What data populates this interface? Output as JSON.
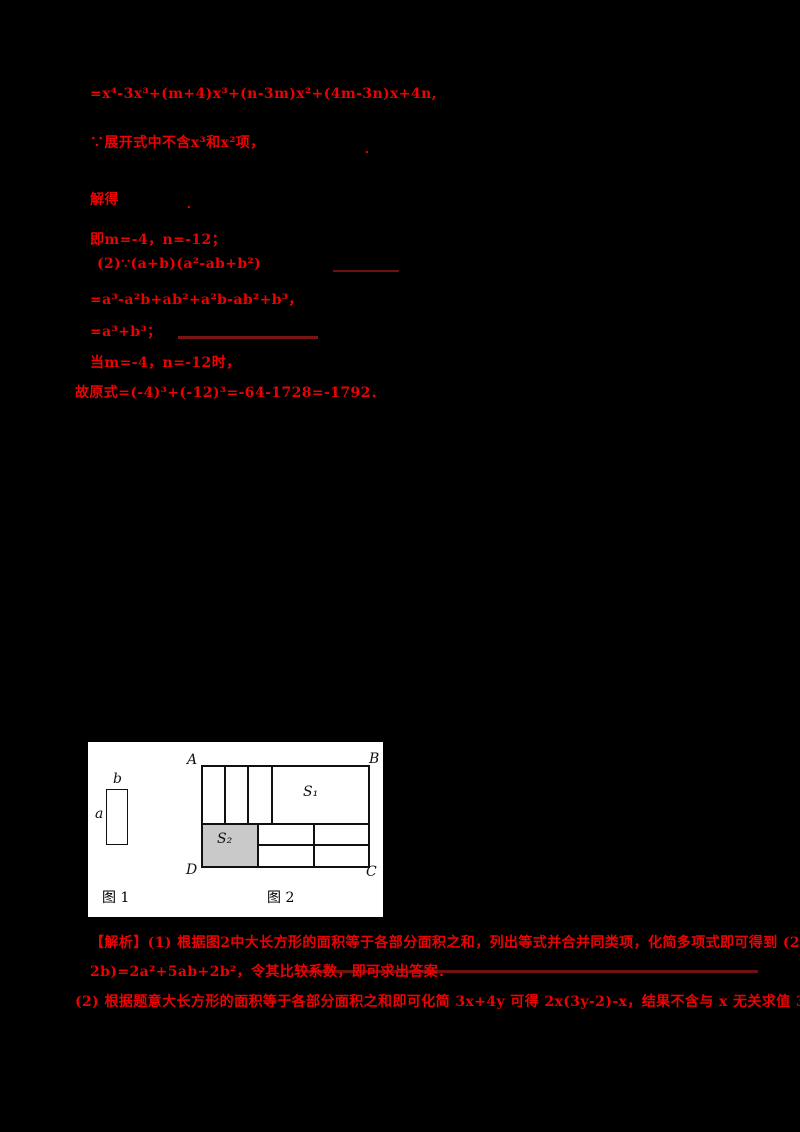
{
  "colors": {
    "background": "#000000",
    "accent_red": "#ec0202",
    "streak_red": "#6e1111",
    "figure_background": "#ffffff",
    "s2_fill": "#c9c9c9"
  },
  "solution": {
    "line1": "=x⁴-3x³+(m+4)x³+(n-3m)x²+(4m-3n)x+4n,",
    "line2": "∵展开式中不含x³和x²项，",
    "line2_period": "．",
    "line3": "解得",
    "line3_period": "．",
    "line4": "即m=-4，n=-12；",
    "line5": "(2)∵(a+b)(a²-ab+b²)",
    "line6": "=a³-a²b+ab²+a²b-ab²+b³，",
    "line7": "=a³+b³；",
    "line8": "当m=-4，n=-12时，",
    "line9": "故原式=(-4)³+(-12)³=-64-1728=-1792．"
  },
  "figure": {
    "fig1": {
      "label_a": "a",
      "label_b": "b",
      "caption": "图 1"
    },
    "fig2": {
      "corner_a": "A",
      "corner_b": "B",
      "corner_c": "C",
      "corner_d": "D",
      "region_s1": "S₁",
      "region_s2": "S₂",
      "caption": "图 2"
    }
  },
  "analysis": {
    "line1": "【解析】(1) 根据图2中大长方形的面积等于各部分面积之和，列出等式并合并同类项，化简多项式即可得到 (2a+",
    "line2": "2b)=2a²+5ab+2b²，令其比较系数，即可求出答案．",
    "line3": "(2) 根据题意大长方形的面积等于各部分面积之和即可化简 3x+4y 可得 2x(3y-2)-x，结果不含与 x 无关求值 3y-"
  }
}
